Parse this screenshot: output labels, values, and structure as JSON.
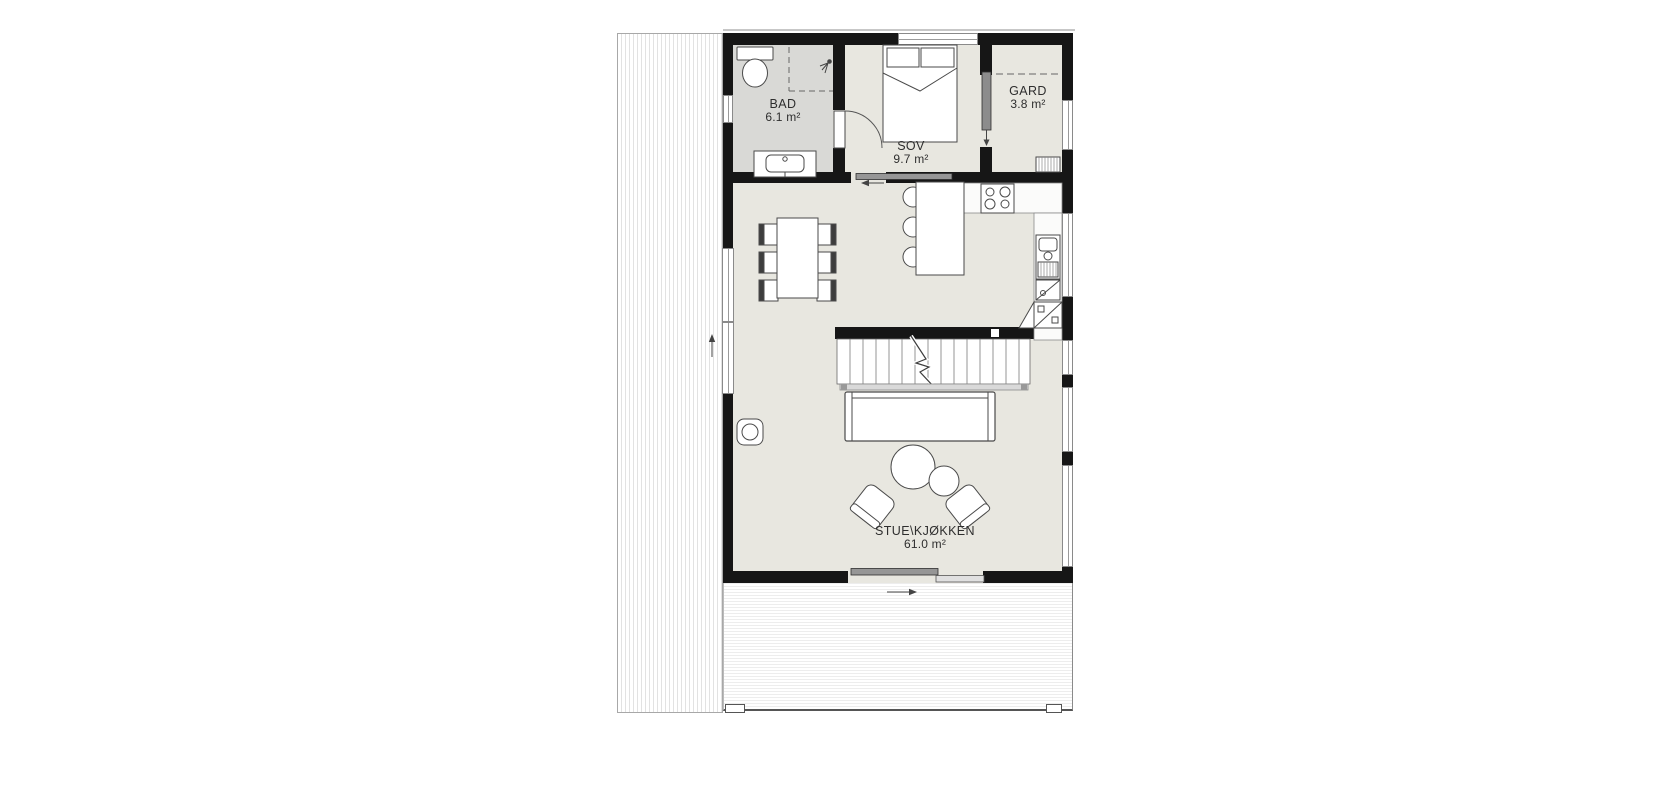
{
  "plan_title": "Floor plan",
  "rooms": [
    {
      "name": "BAD",
      "area": "6.1 m²"
    },
    {
      "name": "SOV",
      "area": "9.7 m²"
    },
    {
      "name": "GARD",
      "area": "3.8 m²"
    },
    {
      "name": "STUE\\KJØKKEN",
      "area": "61.0 m²"
    }
  ],
  "colors": {
    "wall": "#161616",
    "room_fill": "#e8e7e0",
    "bathroom_fill": "#d9d9d6",
    "furniture_outline": "#4a4a4a",
    "deck_stripe": "#e2e2e2"
  }
}
